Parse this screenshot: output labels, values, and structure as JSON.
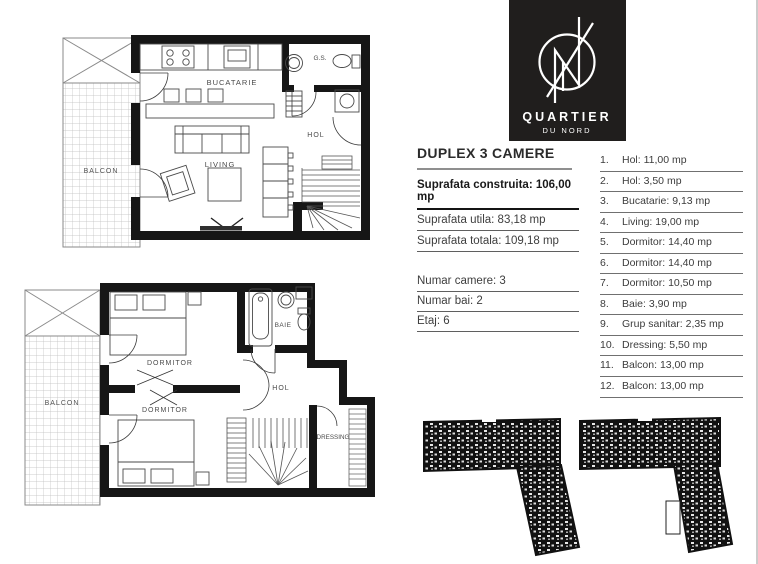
{
  "logo": {
    "brand": "QUARTIER",
    "subbrand": "DU NORD",
    "bg": "#201e1d"
  },
  "details": {
    "title": "DUPLEX 3 CAMERE",
    "area_rows": [
      {
        "text": "Suprafata construita: 106,00 mp"
      },
      {
        "text": "Suprafata utila: 83,18 mp"
      },
      {
        "text": "Suprafata totala: 109,18 mp"
      }
    ],
    "meta_rows": [
      {
        "text": "Numar camere: 3"
      },
      {
        "text": "Numar bai: 2"
      },
      {
        "text": "Etaj: 6"
      }
    ]
  },
  "rooms": {
    "items": [
      {
        "num": "1.",
        "text": "Hol: 11,00 mp"
      },
      {
        "num": "2.",
        "text": "Hol: 3,50 mp"
      },
      {
        "num": "3.",
        "text": "Bucatarie: 9,13 mp"
      },
      {
        "num": "4.",
        "text": "Living: 19,00 mp"
      },
      {
        "num": "5.",
        "text": "Dormitor: 14,40 mp"
      },
      {
        "num": "6.",
        "text": "Dormitor: 14,40 mp"
      },
      {
        "num": "7.",
        "text": "Dormitor: 10,50 mp"
      },
      {
        "num": "8.",
        "text": "Baie: 3,90 mp"
      },
      {
        "num": "9.",
        "text": "Grup sanitar: 2,35 mp"
      },
      {
        "num": "10.",
        "text": "Dressing: 5,50 mp"
      },
      {
        "num": "11.",
        "text": "Balcon: 13,00 mp"
      },
      {
        "num": "12.",
        "text": "Balcon: 13,00 mp"
      }
    ]
  },
  "plan_upper": {
    "labels": {
      "balcon": "BALCON",
      "bucatarie": "BUCATARIE",
      "gs": "G.S.",
      "living": "LIVING",
      "hol": "HOL"
    }
  },
  "plan_lower": {
    "labels": {
      "balcon": "BALCON",
      "dormitor1": "DORMITOR",
      "dormitor2": "DORMITOR",
      "baie": "BAIE",
      "hol": "HOL",
      "dressing": "DRESSING"
    }
  },
  "colors": {
    "wall": "#161616",
    "furniture_line": "#4a4a4a",
    "grid": "#bdbdbd",
    "text": "#3c3c3c"
  }
}
